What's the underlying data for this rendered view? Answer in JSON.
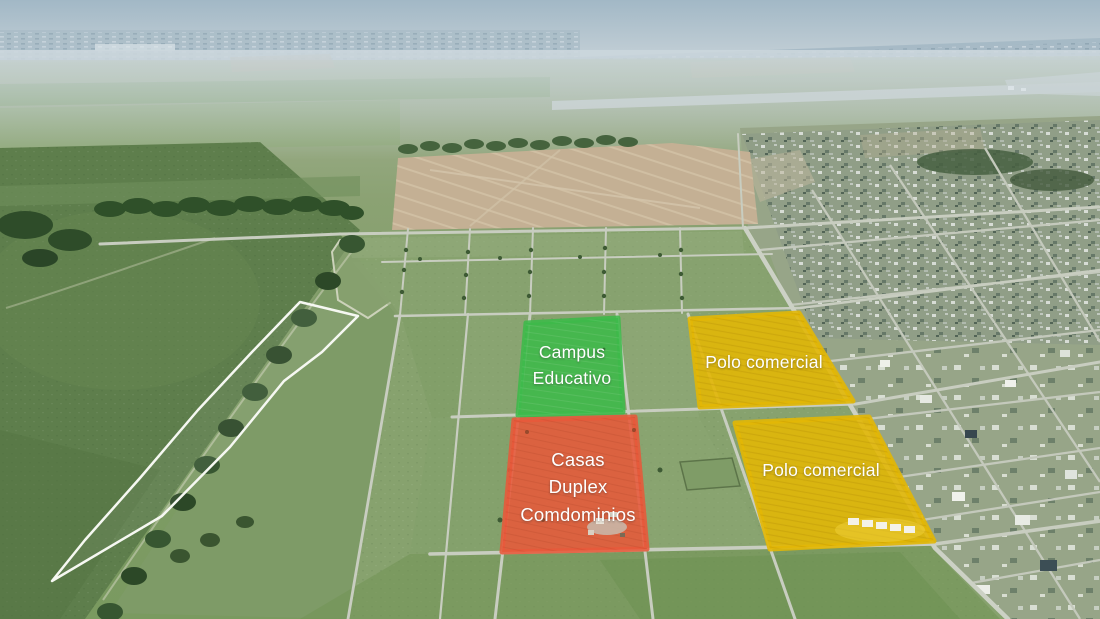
{
  "zones": [
    {
      "id": "campus-educativo",
      "label_lines": [
        "Campus",
        "Educativo"
      ],
      "color": "#3eb94a"
    },
    {
      "id": "polo-comercial-north",
      "label_lines": [
        "Polo comercial"
      ],
      "color": "#e2b705"
    },
    {
      "id": "casas-duplex-condominios",
      "label_lines": [
        "Casas",
        "Duplex",
        "Comdominios"
      ],
      "color": "#e7593a"
    },
    {
      "id": "polo-comercial-south",
      "label_lines": [
        "Polo comercial"
      ],
      "color": "#e2b705"
    }
  ],
  "label_text_color": "#ffffff"
}
